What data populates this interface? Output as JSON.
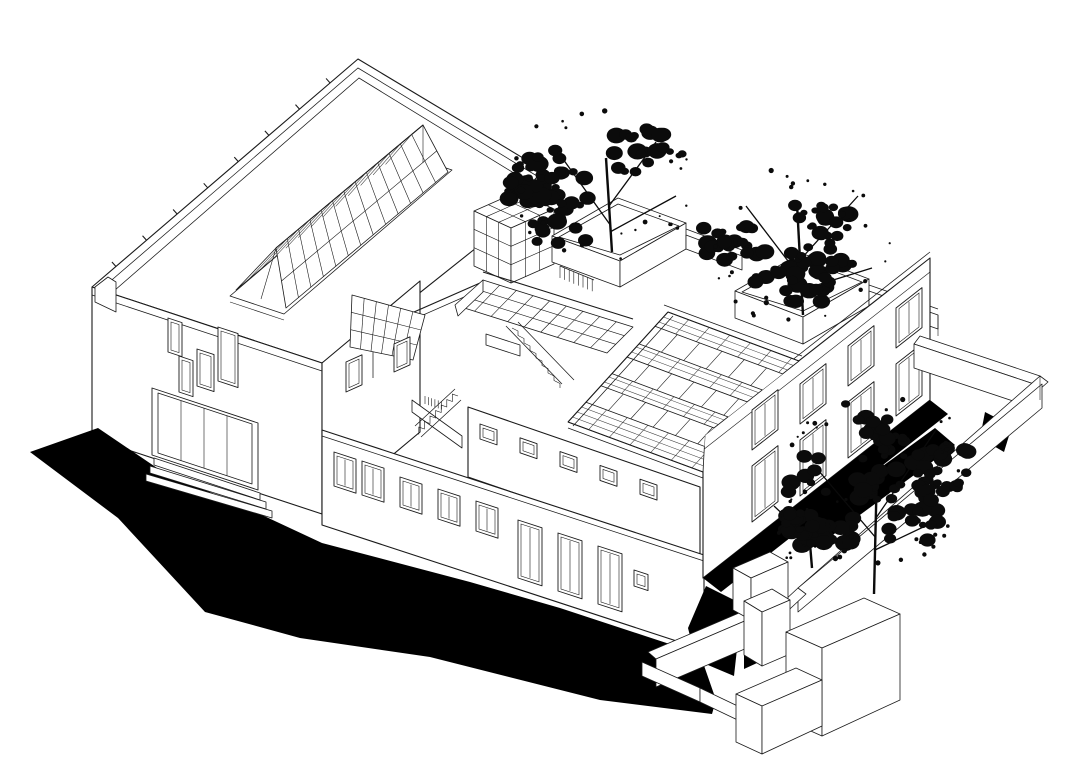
{
  "meta": {
    "title": "Axonometric architectural line drawing of a courtyard building complex with rooftop trees",
    "background_color": "#ffffff",
    "ink_color": "#1a1a1a",
    "shadow_color": "#000000",
    "tile_line_color": "#3c3c3c"
  },
  "scene": {
    "style": "black ink axonometric on white",
    "elements": [
      "flat-roof-hall",
      "ridge-skylight",
      "parapet-drain-ticks",
      "small-window-cluster",
      "display-window",
      "courtyard-glass-cube",
      "courtyard-glazed-skylight",
      "secondary-glazed-skylight",
      "upper-stair-run",
      "lower-stair-run",
      "terrace-railing",
      "clerestory-band",
      "front-wing-windows",
      "front-wing-doors",
      "gabled-tile-roof",
      "roof-skylight-strips",
      "two-storey-block",
      "walled-garden",
      "tree-planter-boxes",
      "service-court-boxes",
      "cast-shadows",
      "ink-trees"
    ]
  },
  "counts": {
    "parapet_ticks": 8,
    "ridge_skylight_bars": 12,
    "courtyard_skylight_bays": 9,
    "tile_rows": 21,
    "roof_skylight_strips": 3,
    "wing_windows": 5,
    "wing_doors": 3,
    "clerestory_windows": 5,
    "right_facade_windows": 8,
    "display_window_panes": 4,
    "planters": 2,
    "trees": 3
  },
  "trees": [
    {
      "id": "tree-1",
      "cx": 602,
      "cy": 183,
      "rx": 95,
      "ry": 80,
      "seed": 11,
      "clusters": 8,
      "speckles": 26,
      "trunk": [
        [
          612,
          252
        ],
        [
          606,
          158
        ]
      ],
      "branches": [
        [
          [
            611,
            226
          ],
          [
            558,
            152
          ]
        ],
        [
          [
            609,
            206
          ],
          [
            656,
            142
          ]
        ],
        [
          [
            610,
            232
          ],
          [
            676,
            196
          ]
        ]
      ]
    },
    {
      "id": "tree-2",
      "cx": 802,
      "cy": 246,
      "rx": 98,
      "ry": 80,
      "seed": 23,
      "clusters": 8,
      "speckles": 26,
      "trunk": [
        [
          803,
          315
        ],
        [
          797,
          204
        ]
      ],
      "branches": [
        [
          [
            801,
            278
          ],
          [
            746,
            206
          ]
        ],
        [
          [
            800,
            260
          ],
          [
            858,
            196
          ]
        ],
        [
          [
            801,
            290
          ],
          [
            872,
            268
          ]
        ]
      ]
    },
    {
      "id": "tree-3",
      "cx": 880,
      "cy": 478,
      "rx": 96,
      "ry": 88,
      "seed": 37,
      "clusters": 9,
      "speckles": 30,
      "trunk": [
        [
          874,
          594
        ],
        [
          877,
          468
        ]
      ],
      "branches": [
        [
          [
            876,
            538
          ],
          [
            818,
            470
          ]
        ],
        [
          [
            876,
            518
          ],
          [
            936,
            430
          ]
        ],
        [
          [
            875,
            550
          ],
          [
            938,
            520
          ]
        ]
      ]
    },
    {
      "id": "tree-3b",
      "cx": 806,
      "cy": 524,
      "rx": 50,
      "ry": 45,
      "seed": 53,
      "clusters": 4,
      "speckles": 12,
      "trunk": [
        [
          812,
          568
        ],
        [
          807,
          508
        ]
      ],
      "branches": [
        [
          [
            810,
            540
          ],
          [
            774,
            506
          ]
        ]
      ]
    }
  ]
}
